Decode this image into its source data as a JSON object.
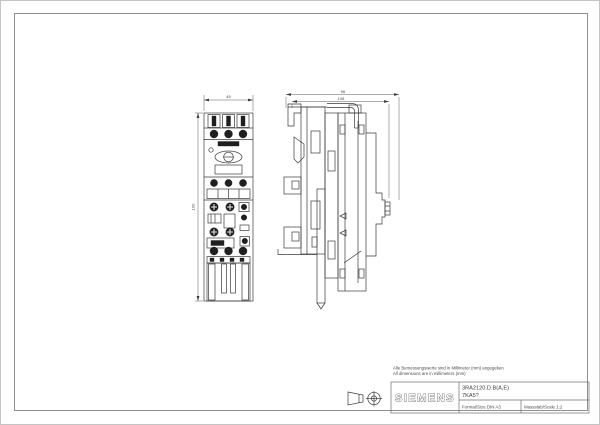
{
  "notes": {
    "line1": "Alle Bemessungswerte sind in Millimeter (mm) angegeben",
    "line2": "All dimensions are in millimeters (mm)"
  },
  "title_block": {
    "brand": "SIEMENS",
    "part_line1": "3RA2120.D.B(A,E)",
    "part_line2": "7KA5?",
    "format": "Format/Size DIN A3",
    "scale": "Massstab/Scale 1:2"
  },
  "dims": {
    "front_width": "45",
    "front_height": "190",
    "side_depth_upper": "96",
    "side_depth_lower": "108"
  },
  "symbols": {
    "projection": "first-angle-projection-symbol"
  },
  "colors": {
    "line": "#3a3a3a",
    "frame": "#8f8f8f",
    "page_border": "#c4c4c4",
    "dark_fill": "#1f1f1f",
    "text": "#4a4a4a"
  }
}
